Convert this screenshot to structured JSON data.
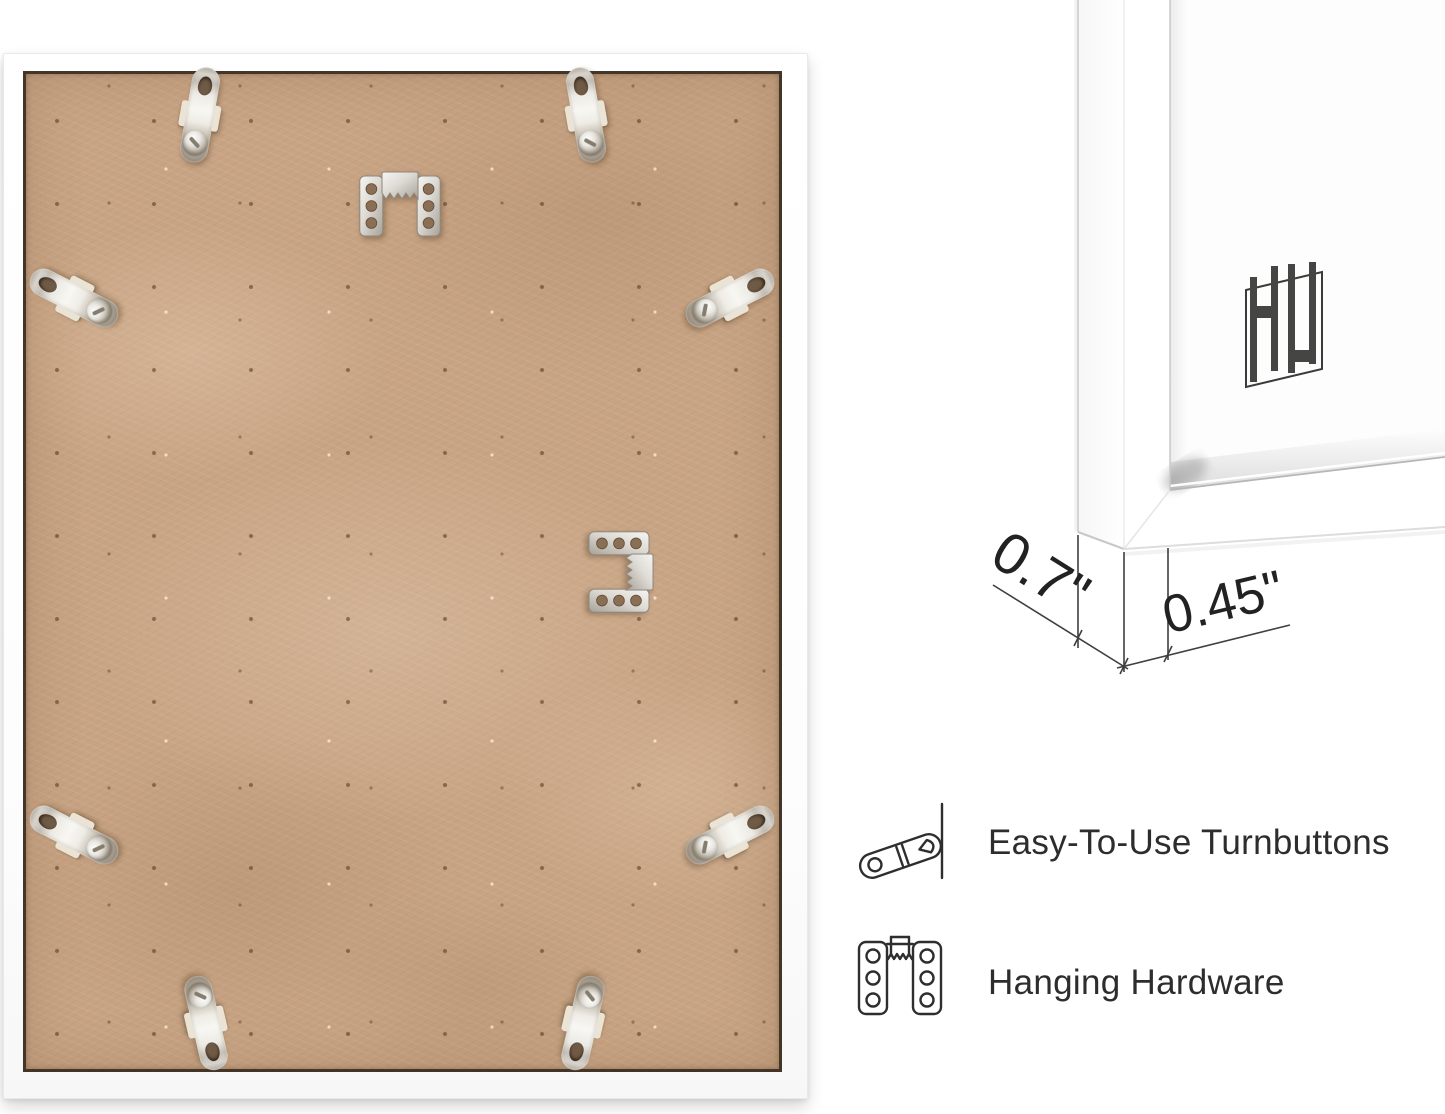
{
  "frame_back": {
    "board_color": "#c8a484",
    "frame_color": "#ffffff",
    "turnbutton_count": 8,
    "hanger_count": 2
  },
  "corner_view": {
    "depth": "0.7\"",
    "face": "0.45\"",
    "logo_icon": "hh-monogram"
  },
  "features": [
    {
      "icon": "turnbutton-icon",
      "label": "Easy-To-Use Turnbuttons"
    },
    {
      "icon": "hanging-hardware-icon",
      "label": "Hanging Hardware"
    }
  ],
  "colors": {
    "background": "#ffffff",
    "text": "#2d2d2d",
    "dimension_lines": "#3f3f3f",
    "metal": "#d9d6d0",
    "logo": "#454543"
  }
}
